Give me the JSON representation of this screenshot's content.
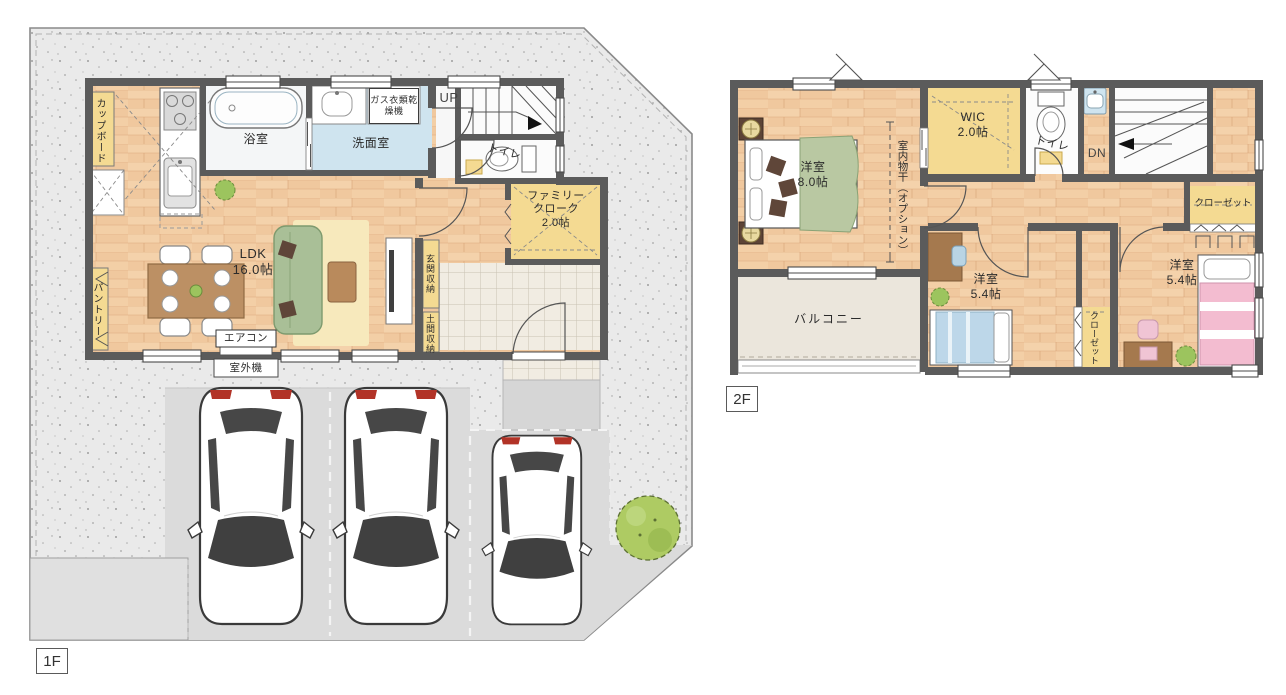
{
  "title": "住宅間取り図（1F・2F）",
  "floor1": {
    "badge": "1F",
    "rooms": {
      "ldk": {
        "name": "LDK",
        "size": "16.0帖"
      },
      "bath": "浴室",
      "washroom": "洗面室",
      "toilet": "トイレ",
      "family_cloak": {
        "line1": "ファミリー",
        "line2": "クローク",
        "size": "2.0帖"
      }
    },
    "fixtures": {
      "cupboard": "カップボード",
      "pantry": "パントリー",
      "gas_dryer": "ガス衣類乾燥機",
      "genkan_storage": "玄関収納",
      "doma_storage": "土間収納",
      "aircon": "エアコン",
      "outdoor_unit": "室外機",
      "stairs_up": "UP"
    }
  },
  "floor2": {
    "badge": "2F",
    "rooms": {
      "bedroom_main": {
        "name": "洋室",
        "size": "8.0帖"
      },
      "bedroom_center": {
        "name": "洋室",
        "size": "5.4帖"
      },
      "bedroom_right": {
        "name": "洋室",
        "size": "5.4帖"
      },
      "wic": {
        "name": "WIC",
        "size": "2.0帖"
      },
      "toilet": "トイレ",
      "balcony": "バルコニー"
    },
    "fixtures": {
      "indoor_drying": "室内物干（オプション）",
      "closet_top": "クローゼット",
      "closet_mid": "クローゼット",
      "stairs_down": "DN"
    }
  },
  "colors": {
    "wall": "#5b5b5b",
    "wood_floor": "#f1cba0",
    "closet_yellow": "#f4da92",
    "washroom_blue": "#cfe4ef",
    "balcony_gray": "#ebe6dc",
    "site_concrete": "#eaeaea",
    "parking_gray": "#dbdbdb",
    "entry_tile": "#f1ece2",
    "sofa_green": "#a9bf97",
    "rug_yellow": "#f7e9bc",
    "tree_green": "#aecb63",
    "bed_green": "#b9c8a2",
    "bed_blue": "#bdd7e9",
    "bed_pink": "#f3bcd0",
    "taillight_red": "#b23327"
  }
}
